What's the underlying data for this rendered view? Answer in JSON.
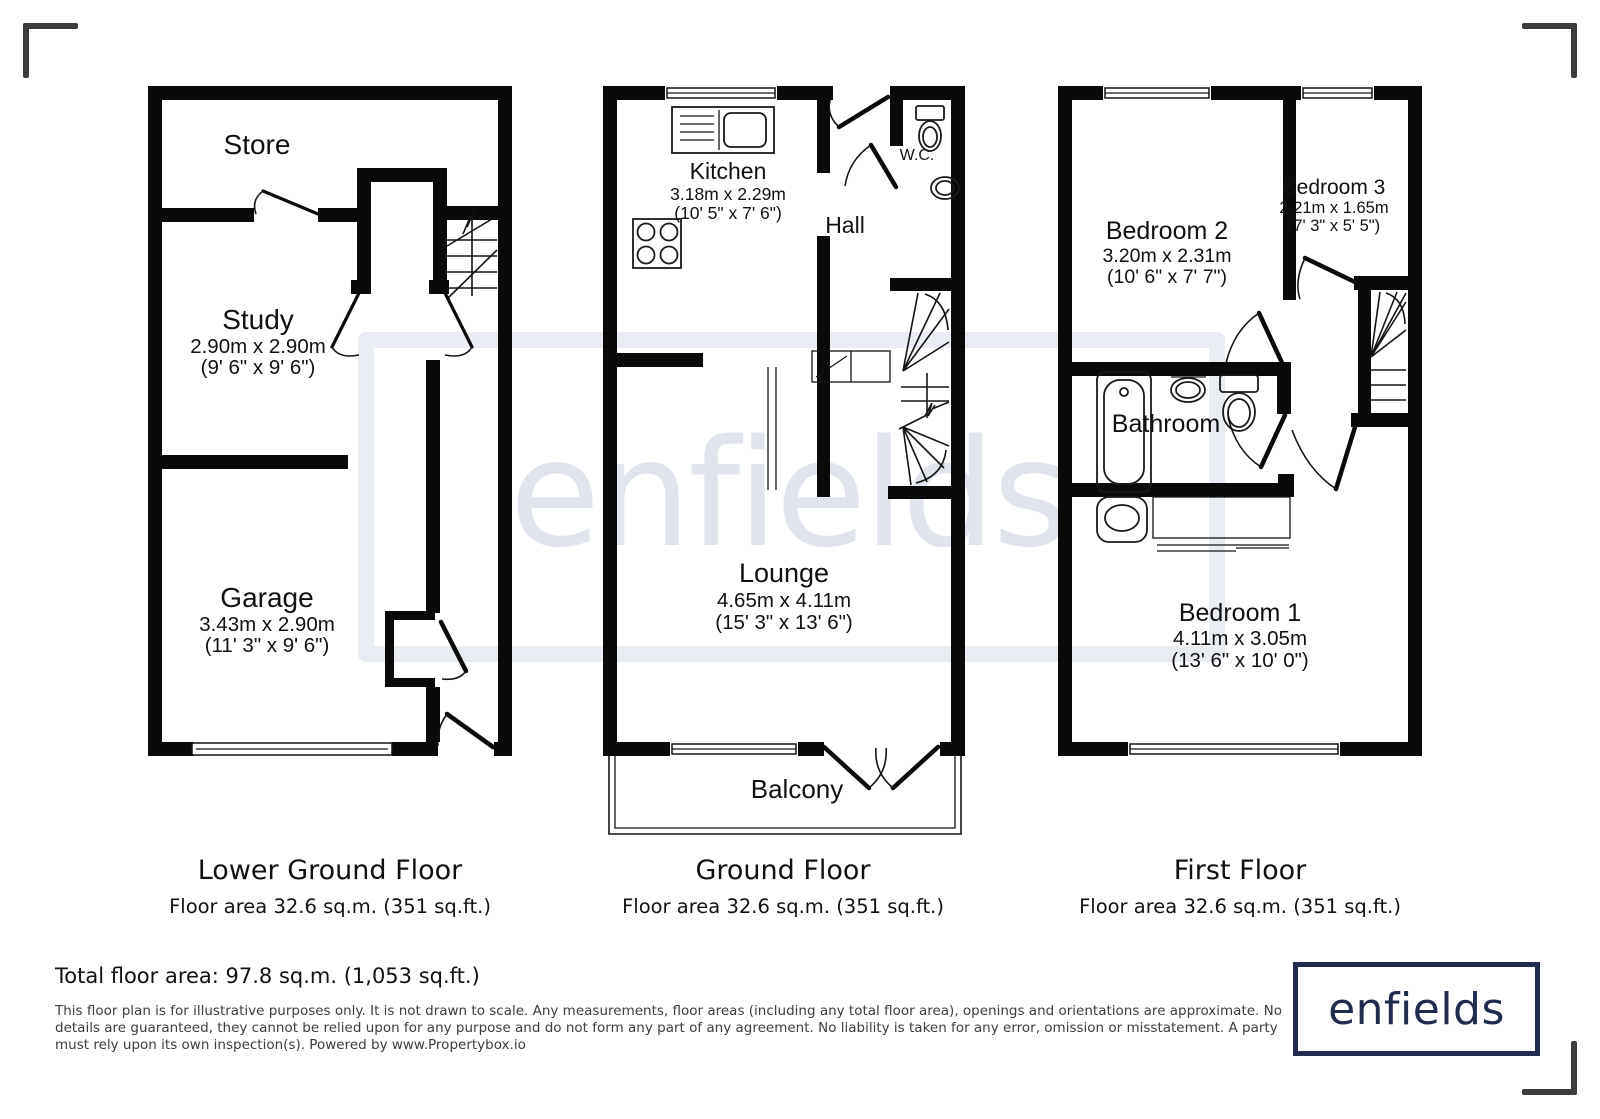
{
  "watermark": {
    "text": "enfields"
  },
  "plans": [
    {
      "id": "lower-ground-floor",
      "title": "Lower Ground Floor",
      "area_label": "Floor area 32.6 sq.m. (351 sq.ft.)",
      "rooms": [
        {
          "name": "Store",
          "dim_m": "",
          "dim_ft": ""
        },
        {
          "name": "Study",
          "dim_m": "2.90m x 2.90m",
          "dim_ft": "(9' 6\" x 9' 6\")"
        },
        {
          "name": "Garage",
          "dim_m": "3.43m x 2.90m",
          "dim_ft": "(11' 3\" x 9' 6\")"
        }
      ]
    },
    {
      "id": "ground-floor",
      "title": "Ground Floor",
      "area_label": "Floor area 32.6 sq.m. (351 sq.ft.)",
      "rooms": [
        {
          "name": "Kitchen",
          "dim_m": "3.18m x 2.29m",
          "dim_ft": "(10' 5\" x 7' 6\")"
        },
        {
          "name": "W.C.",
          "dim_m": "",
          "dim_ft": ""
        },
        {
          "name": "Hall",
          "dim_m": "",
          "dim_ft": ""
        },
        {
          "name": "Lounge",
          "dim_m": "4.65m x 4.11m",
          "dim_ft": "(15' 3\" x 13' 6\")"
        },
        {
          "name": "Balcony",
          "dim_m": "",
          "dim_ft": ""
        }
      ]
    },
    {
      "id": "first-floor",
      "title": "First Floor",
      "area_label": "Floor area 32.6 sq.m. (351 sq.ft.)",
      "rooms": [
        {
          "name": "Bedroom 2",
          "dim_m": "3.20m x 2.31m",
          "dim_ft": "(10' 6\" x 7' 7\")"
        },
        {
          "name": "Bedroom 3",
          "dim_m": "2.21m x 1.65m",
          "dim_ft": "(7' 3\" x 5' 5\")"
        },
        {
          "name": "Bathroom",
          "dim_m": "",
          "dim_ft": ""
        },
        {
          "name": "Bedroom 1",
          "dim_m": "4.11m x 3.05m",
          "dim_ft": "(13' 6\" x 10' 0\")"
        }
      ]
    }
  ],
  "total_area": "Total floor area: 97.8 sq.m. (1,053 sq.ft.)",
  "disclaimer_lines": [
    "This floor plan is for illustrative purposes only. It is not drawn to scale. Any measurements, floor areas (including any total floor area), openings and orientations are approximate. No",
    "details are guaranteed, they cannot be relied upon for any purpose and do not form any part of any agreement. No liability is taken for any error, omission or misstatement. A party",
    "must rely upon its own inspection(s). Powered by www.Propertybox.io"
  ],
  "logo": {
    "text": "enfields"
  },
  "colors": {
    "wall": "#0a0a0a",
    "logo_navy": "#1f2c4e",
    "watermark": "#e9edf3",
    "corner_mark": "#3d3d3d"
  }
}
